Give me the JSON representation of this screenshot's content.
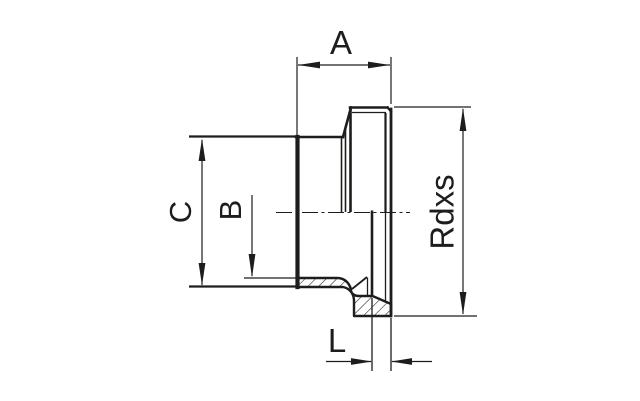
{
  "page": {
    "background": "#ffffff"
  },
  "drawing": {
    "type": "technical-drawing-half-section",
    "subject": "threaded-fitting-cross-section",
    "line_color": "#1d1d1b",
    "hatch_color": "#1d1d1b",
    "dimensions": [
      {
        "id": "width-top",
        "label": "A",
        "position": "top",
        "orientation": "horizontal"
      },
      {
        "id": "outer-diameter",
        "label": "C",
        "position": "left-outer",
        "orientation": "vertical"
      },
      {
        "id": "bore-diameter",
        "label": "B",
        "position": "left-inner",
        "orientation": "vertical"
      },
      {
        "id": "thread-size",
        "label": "Rdxs",
        "position": "right",
        "orientation": "vertical"
      },
      {
        "id": "length-bottom",
        "label": "L",
        "position": "bottom",
        "orientation": "horizontal"
      }
    ]
  }
}
